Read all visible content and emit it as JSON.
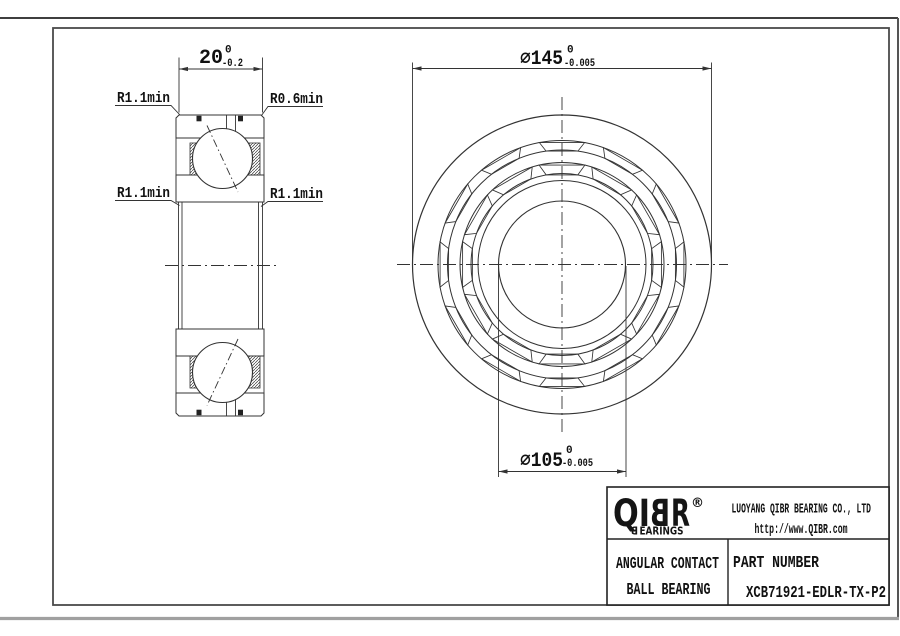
{
  "drawing": {
    "section_view": {
      "width_dim": {
        "nominal": "20",
        "upper_tol": "0",
        "lower_tol": "-0.2"
      },
      "callouts": {
        "top_left": "R1.1min",
        "top_right": "R0.6min",
        "bottom_left": "R1.1min",
        "bottom_right": "R1.1min"
      }
    },
    "front_view": {
      "od_dim": {
        "nominal": "⌀145",
        "upper_tol": "0",
        "lower_tol": "-0.005"
      },
      "bore_dim": {
        "nominal": "⌀105",
        "upper_tol": "0",
        "lower_tol": "-0.005"
      }
    }
  },
  "title_block": {
    "logo": {
      "part1": "QI",
      "mirrored": "B",
      "part2": "R",
      "registered": "®",
      "tagline_mirrored": "B",
      "tagline_rest": "EARINGS"
    },
    "company": "LUOYANG QIBR BEARING CO., LTD",
    "website": "http://www.QIBR.com",
    "product": {
      "line1": "ANGULAR CONTACT",
      "line2": "BALL BEARING"
    },
    "part_number_label": "PART NUMBER",
    "part_number": "XCB71921-EDLR-TX-P2"
  },
  "colors": {
    "line": "#333333",
    "text": "#111111",
    "sheet_edge": "#a0a0a0"
  }
}
